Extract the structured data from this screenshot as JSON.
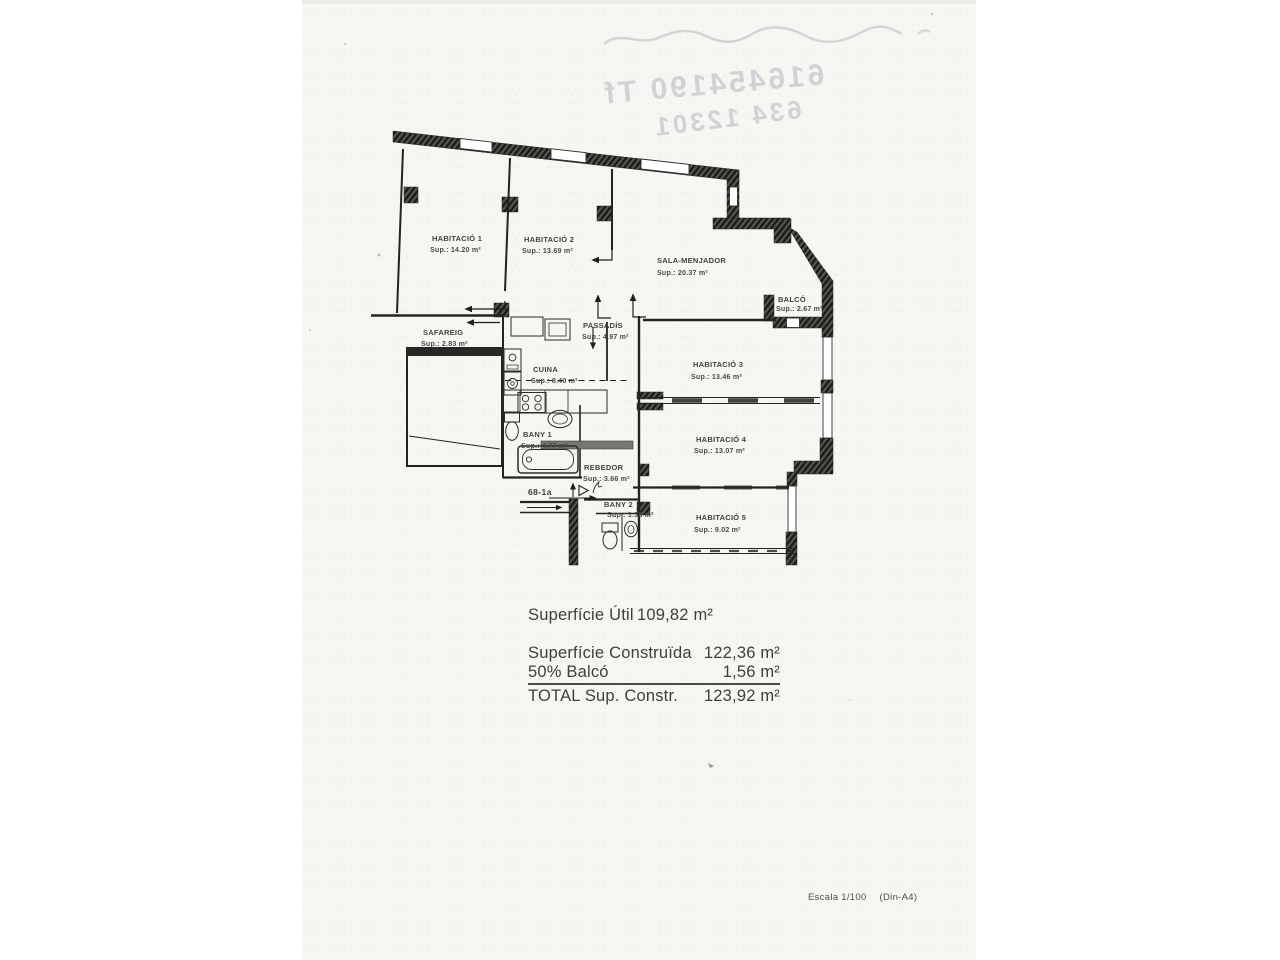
{
  "plan": {
    "rooms": [
      {
        "name": "HABITACIÓ 1",
        "sup": "Sup.: 14.20 m²"
      },
      {
        "name": "HABITACIÓ 2",
        "sup": "Sup.: 13.69 m²"
      },
      {
        "name": "SALA-MENJADOR",
        "sup": "Sup.: 20.37 m²"
      },
      {
        "name": "BALCÓ",
        "sup": "Sup.: 2.67 m²"
      },
      {
        "name": "SAFAREIG",
        "sup": "Sup.: 2.83 m²"
      },
      {
        "name": "PASSADÍS",
        "sup": "Sup.: 4.97 m²"
      },
      {
        "name": "CUINA",
        "sup": "Sup.: 8.40 m²"
      },
      {
        "name": "HABITACIÓ 3",
        "sup": "Sup.: 13.46 m²"
      },
      {
        "name": "BANY 1",
        "sup": "Sup.: 4.77 m²"
      },
      {
        "name": "HABITACIÓ 4",
        "sup": "Sup.: 13.07 m²"
      },
      {
        "name": "REBEDOR",
        "sup": "Sup.: 3.66 m²"
      },
      {
        "name": "BANY 2",
        "sup": "Sup.: 1.38 m²"
      },
      {
        "name": "HABITACIÓ 5",
        "sup": "Sup.: 9.02 m²"
      }
    ],
    "entrance_label": "68-1a"
  },
  "summary": {
    "rows": [
      {
        "label": "Superfície Útil",
        "value": "109,82 m²"
      },
      {
        "label": "Superfície Construïda",
        "value": "122,36 m²"
      },
      {
        "label": "50% Balcó",
        "value": "1,56 m²"
      },
      {
        "label": "TOTAL Sup. Constr.",
        "value": "123,92 m²"
      }
    ]
  },
  "footer": {
    "scale": "Escala 1/100",
    "paper": "(Din-A4)"
  },
  "bleedthrough": {
    "line1": "616454190 Tf",
    "line2": "634 12301"
  },
  "colors": {
    "ink": "#2a2a2a",
    "wall_dark": "#3c3c3a",
    "paper": "#f7f6f2",
    "bleed": "#c9c9ce"
  }
}
